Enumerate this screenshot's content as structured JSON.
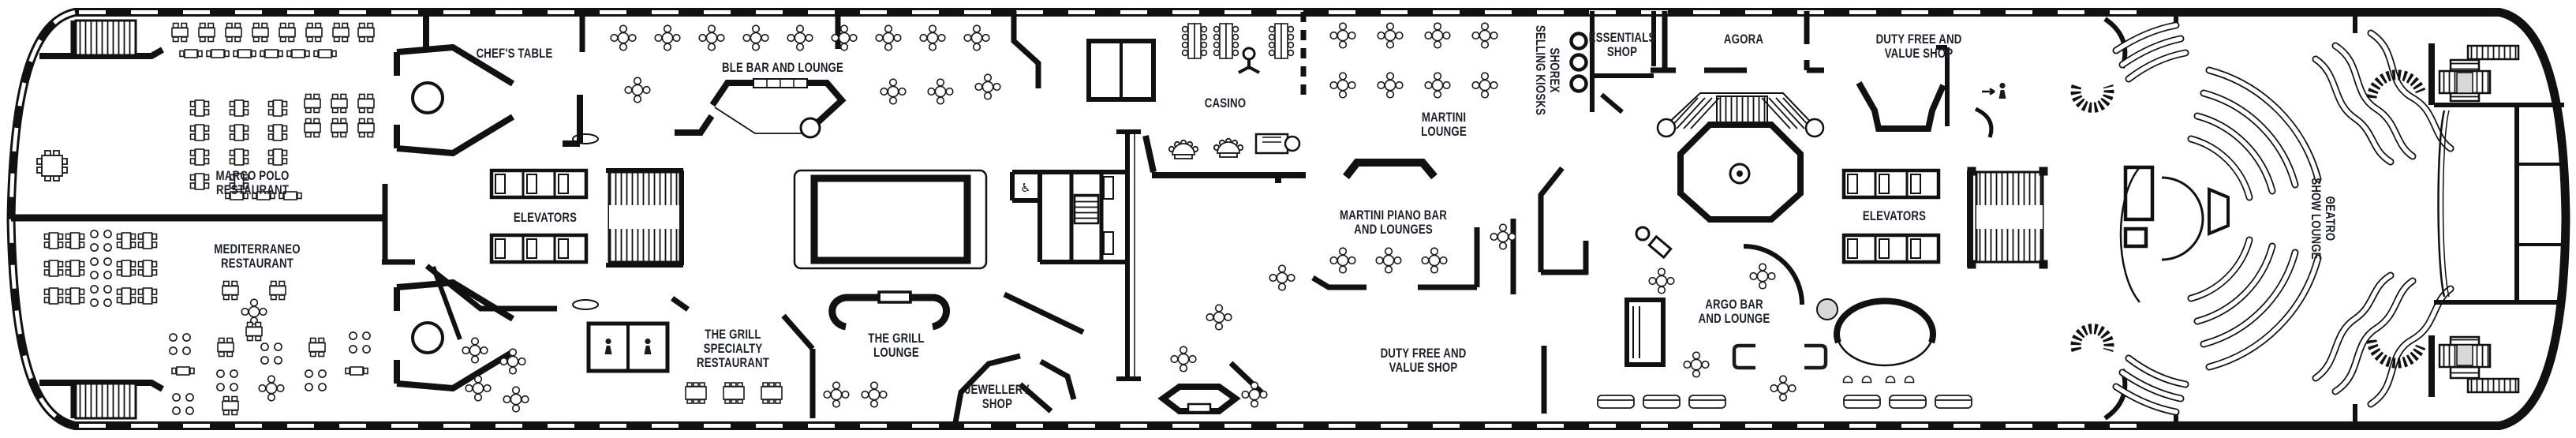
{
  "meta": {
    "background_color": "#ffffff",
    "line_color": "#111111",
    "label_color": "#1d1f2a",
    "elevator_shaft_gray": "#d8d8d8"
  },
  "rooms": {
    "marco_polo_restaurant": {
      "label": "MARCO POLO\nRESTAURANT"
    },
    "mediterraneo_restaurant": {
      "label": "MEDITERRANEO\nRESTAURANT"
    },
    "chefs_table": {
      "label": "CHEF'S TABLE"
    },
    "ble_bar_and_lounge": {
      "label": "BLE BAR AND LOUNGE"
    },
    "elevators_forward": {
      "label": "ELEVATORS"
    },
    "the_grill_specialty_restaurant": {
      "label": "THE GRILL\nSPECIALTY\nRESTAURANT"
    },
    "the_grill_lounge": {
      "label": "THE GRILL\nLOUNGE"
    },
    "jewellery_shop": {
      "label": "JEWELLERY\nSHOP"
    },
    "casino": {
      "label": "CASINO"
    },
    "martini_lounge": {
      "label": "MARTINI\nLOUNGE"
    },
    "martini_piano_bar_and_lounges": {
      "label": "MARTINI PIANO BAR\nAND LOUNGES"
    },
    "duty_free_and_value_shop_midship": {
      "label": "DUTY FREE AND\nVALUE SHOP"
    },
    "shorex_selling_kiosks": {
      "label": "SHOREX\nSELLING KIOSKS"
    },
    "essentials_shop": {
      "label": "ESSENTIALS\nSHOP"
    },
    "agora": {
      "label": "AGORA"
    },
    "duty_free_and_value_shop_aft": {
      "label": "DUTY FREE AND\nVALUE SHOP"
    },
    "elevators_aft": {
      "label": "ELEVATORS"
    },
    "argo_bar_and_lounge": {
      "label": "ARGO BAR\nAND LOUNGE"
    },
    "teatro_show_lounge": {
      "label": "ΘEATRO\nSHOW LOUNGE"
    }
  },
  "icons": {
    "wheelchair_accessible": {
      "glyph": "♿"
    },
    "male_restroom": {
      "name": "male-restroom-icon"
    },
    "female_restroom": {
      "name": "female-restroom-icon"
    },
    "shorex_kiosk_count": 3
  }
}
